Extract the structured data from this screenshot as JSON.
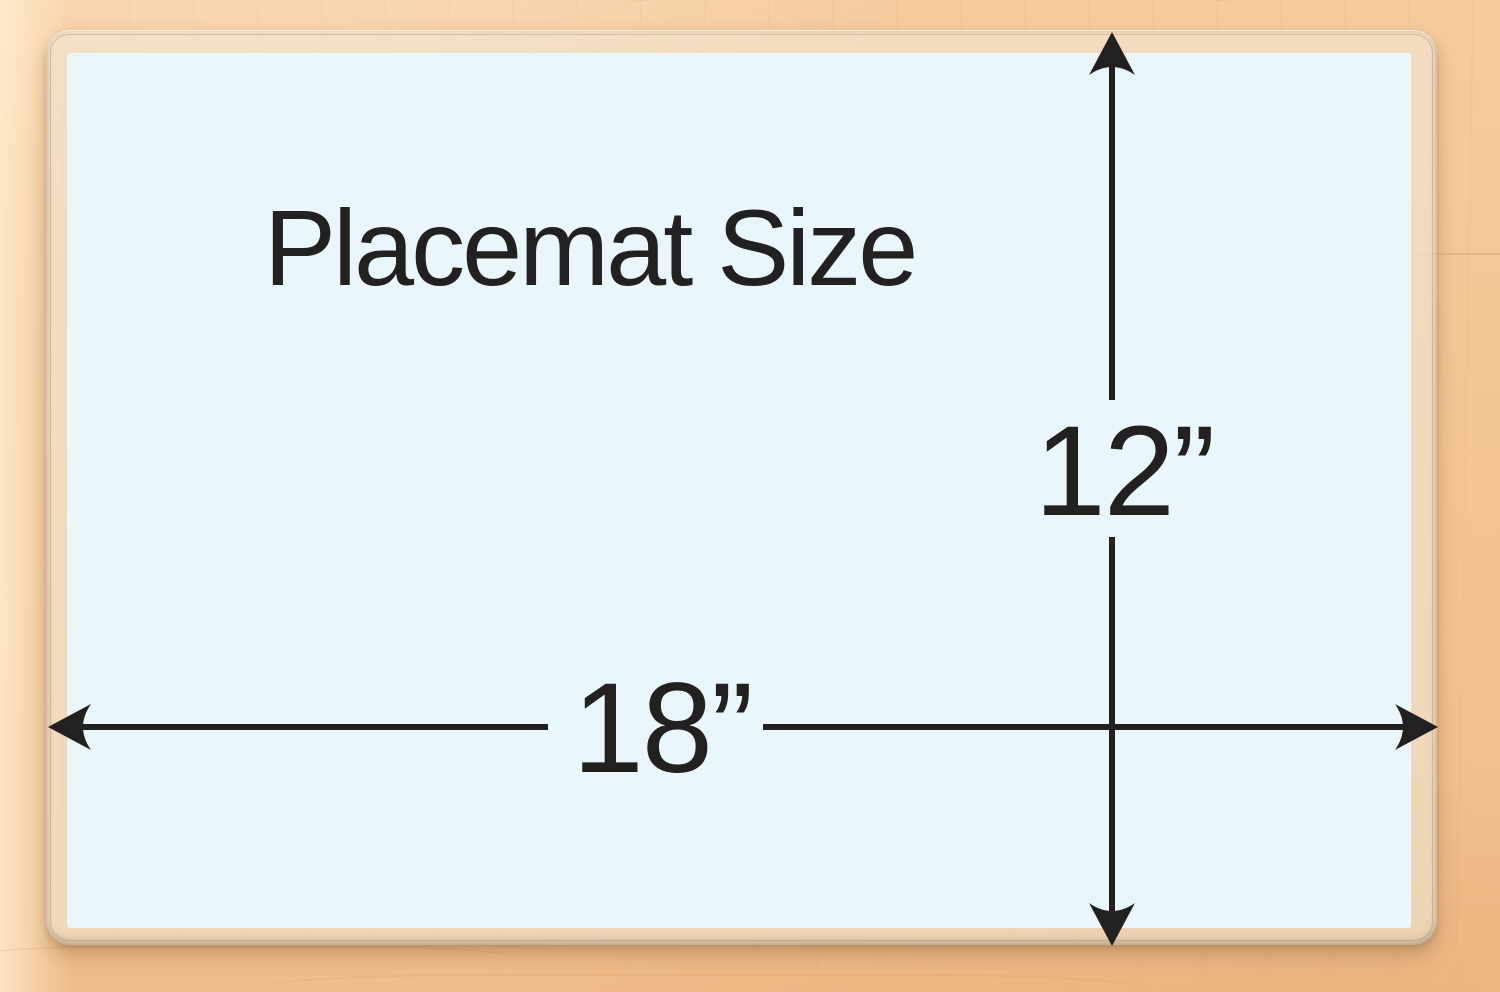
{
  "diagram": {
    "title": "Placemat Size",
    "width_label": "18”",
    "height_label": "12”"
  },
  "colors": {
    "placemat_surface": "#e9f6fb",
    "laminate_edge": "#e5d6c2",
    "wood_background": "#f3c394",
    "line_and_text": "#232021"
  }
}
